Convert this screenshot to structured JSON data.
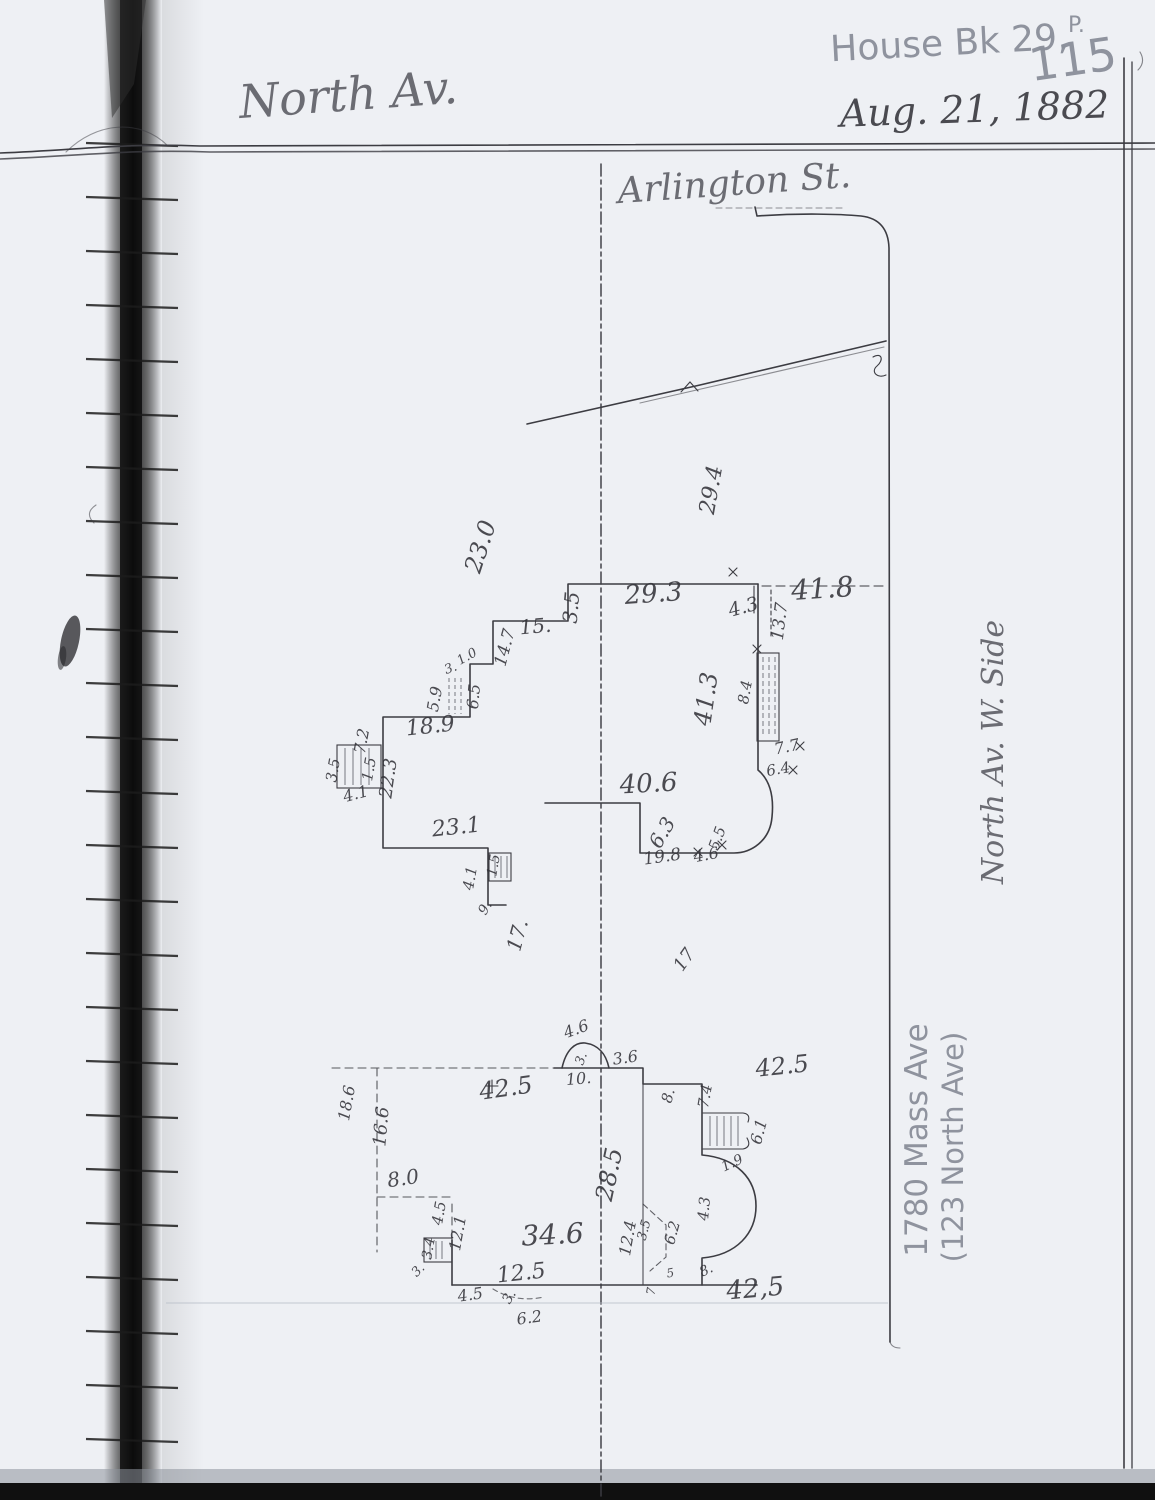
{
  "header": {
    "book_ref": "House Bk 29,",
    "page_label": "P.",
    "page_number": "115",
    "date": "Aug. 21, 1882"
  },
  "streets": {
    "north_av_top": "North Av.",
    "arlington": "Arlington St.",
    "north_av_right": "North Av. W. Side"
  },
  "notes": {
    "address_modern": "1780 Mass Ave",
    "address_old": "(123 North Ave)"
  },
  "upper_plan": {
    "d23_0": "23.0",
    "d29_3": "29.3",
    "d41_8": "41.8",
    "d3_5a": "3.5",
    "d4_3": "4.3",
    "d13_7": "13.7",
    "d15": "15.",
    "d14_7": "14.7",
    "d1_0": "1.0",
    "d3": "3.",
    "d5_9": "5.9",
    "d6_5": "6.5",
    "d18_9": "18.9",
    "d7_2": "7.2",
    "d3_5b": "3.5",
    "d1_5a": "1.5",
    "d4_1a": "4.1",
    "d22_3": "22.3",
    "d23_1": "23.1",
    "d4_1b": "4.1",
    "d1_5b": "1.5",
    "d9": "9.",
    "d17a": "17.",
    "d17b": "17",
    "d40_6": "40.6",
    "d6_3": "6.3",
    "d19_8": "19.8",
    "d4_6": "4.6",
    "d5_5": "5.5",
    "d41_3": "41.3",
    "d8_4": "8.4",
    "d7_7": "7.7",
    "d6_4": "6.4",
    "d29_4": "29.4"
  },
  "lower_plan": {
    "d18_6": "18.6",
    "d16_6": "16.6",
    "d8_0": "8.0",
    "d42_5a": "42.5",
    "d4_6": "4.6",
    "d3a": "3.",
    "d3_6": "3.6",
    "d10": "10.",
    "d8a": "8.",
    "d7_4": "7.4",
    "d42_5b": "42.5",
    "d6_1": "6.1",
    "d1_9": "1.9",
    "d28_5": "28.5",
    "d12_4": "12.4",
    "d3_5": "3.5",
    "d6_2a": "6.2",
    "d4_3": "4.3",
    "d8b": "8.",
    "d5": "5",
    "d7": "7",
    "d42_5c": "42,5",
    "d34_6": "34.6",
    "d12_5": "12.5",
    "d4_5a": "4.5",
    "d12_1": "12.1",
    "d3_4": "3.4",
    "d3b": "3.",
    "d4_5b": "4.5",
    "d3c": "3.",
    "d6_2b": "6.2"
  },
  "colors": {
    "ink": "#34343a",
    "pencil": "#8a8f9a",
    "paper": "#eef0f4",
    "binding": "#0d0d0d"
  }
}
